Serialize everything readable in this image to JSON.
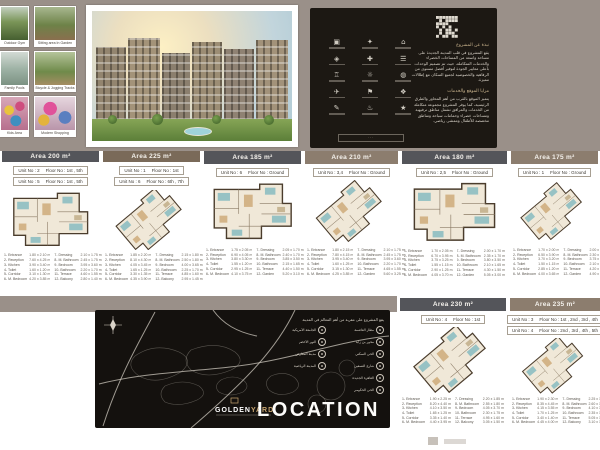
{
  "colors": {
    "page_band": "#9a9089",
    "panel_dark": "#1c1813",
    "header_dark": "#54555a",
    "header_brown": "#7a6a59",
    "header_taupe": "#8c7d6e",
    "accent_gold": "#c9a671"
  },
  "top": {
    "photos": [
      {
        "caption": "Outdoor Gym",
        "variant": "gym"
      },
      {
        "caption": "Sitting area In Garden",
        "variant": "garden"
      },
      {
        "caption": "Family Pools",
        "variant": "pool"
      },
      {
        "caption": "Bicycle & Jogging Tracks",
        "variant": "track"
      },
      {
        "caption": "Kids Area",
        "variant": "kids"
      },
      {
        "caption": "Modern Shopping",
        "variant": "shop"
      }
    ],
    "info_panel": {
      "icons": [
        "▣",
        "✦",
        "⌂",
        "◈",
        "✚",
        "☰",
        "♖",
        "☼",
        "◍",
        "✈",
        "⚑",
        "❖",
        "✎",
        "♨",
        "★"
      ],
      "banner_label": "···",
      "heading_1": "نبذة عن المشروع",
      "paragraph_1": "يقع المشروع في قلب المدينة الجديدة على مساحة واسعة من المساحات الخضراء والخدمات المتكاملة، حيث تم تصميم الوحدات بأعلى معايير الجودة لتوفير أفضل مستوى من الرفاهية والخصوصية لجميع السكان مع إطلالات مميزة.",
      "heading_2": "مزايا الموقع والخدمات",
      "paragraph_2": "يتميز الموقع بالقرب من أهم المحاور والطرق الرئيسية، كما يوفر المشروع مجموعة متكاملة من الخدمات والمرافق تشمل مناطق ترفيهية ومساحات خضراء وحمامات سباحة ومناطق مخصصة للأطفال وممشى رياضي."
    }
  },
  "plans": [
    {
      "area_label": "Area 200 m²",
      "header": "dark",
      "variant": "rect",
      "units": [
        [
          "Unit No : 2",
          "Floor No : 1st , 5th"
        ],
        [
          "Unit No : 5",
          "Floor No : 1st , 5th"
        ]
      ],
      "rooms": [
        "1- Entrance|1.80 x 2.10 m",
        "2- Reception|7.60 x 4.25 m",
        "3- Kitchen|3.90 x 3.40 m",
        "4- Toilet|1.60 x 1.20 m",
        "5- Corridor|3.10 x 1.30 m",
        "6- M. Bedroom|4.20 x 3.85 m",
        "7- Dressing|2.10 x 1.75 m",
        "8- M. Bathroom|2.45 x 1.75 m",
        "9- Bedroom|3.95 x 3.60 m",
        "10- Bathroom|2.20 x 1.70 m",
        "11- Terrace|4.60 x 1.55 m",
        "12- Balcony|2.80 x 1.40 m"
      ]
    },
    {
      "area_label": "Area 225 m²",
      "header": "brown",
      "variant": "diag",
      "units": [
        [
          "Unit No : 1",
          "Floor No : 1st"
        ],
        [
          "Unit No : 6",
          "Floor No : 6th , 7th"
        ]
      ],
      "rooms": [
        "1- Entrance|1.85 x 2.20 m",
        "2- Reception|8.10 x 4.30 m",
        "3- Kitchen|4.05 x 3.45 m",
        "4- Toilet|1.65 x 1.25 m",
        "5- Corridor|3.30 x 1.35 m",
        "6- M. Bedroom|4.35 x 3.90 m",
        "7- Dressing|2.15 x 1.80 m",
        "8- M. Bathroom|2.50 x 1.80 m",
        "9- Bedroom|4.00 x 3.65 m",
        "10- Bathroom|2.25 x 1.70 m",
        "11- Terrace|4.85 x 1.60 m",
        "12- Balcony|2.95 x 1.45 m"
      ]
    },
    {
      "area_label": "Area 185 m²",
      "header": "dark",
      "variant": "rect",
      "units": [
        [
          "Unit No : 6",
          "Floor No : Ground"
        ]
      ],
      "rooms": [
        "1- Entrance|1.75 x 2.05 m",
        "2- Reception|6.90 x 4.05 m",
        "3- Kitchen|3.80 x 3.30 m",
        "4- Toilet|1.55 x 1.20 m",
        "5- Corridor|2.95 x 1.25 m",
        "6- M. Bedroom|4.10 x 3.75 m",
        "7- Dressing|2.05 x 1.70 m",
        "8- M. Bathroom|2.40 x 1.70 m",
        "9- Bedroom|3.85 x 3.50 m",
        "10- Bathroom|2.15 x 1.65 m",
        "11- Terrace|4.40 x 1.50 m",
        "12- Garden|5.20 x 3.10 m"
      ]
    },
    {
      "area_label": "Area 210 m²",
      "header": "taupe",
      "variant": "diag",
      "units": [
        [
          "Unit No : 3,4",
          "Floor No : Ground"
        ]
      ],
      "rooms": [
        "1- Entrance|1.80 x 2.15 m",
        "2- Reception|7.80 x 4.15 m",
        "3- Kitchen|3.95 x 3.40 m",
        "4- Toilet|1.60 x 1.25 m",
        "5- Corridor|3.15 x 1.30 m",
        "6- M. Bedroom|4.25 x 3.85 m",
        "7- Dressing|2.10 x 1.75 m",
        "8- M. Bathroom|2.45 x 1.75 m",
        "9- Bedroom|3.95 x 3.60 m",
        "10- Bathroom|2.20 x 1.70 m",
        "11- Terrace|4.65 x 1.55 m",
        "12- Garden|5.60 x 3.25 m"
      ]
    },
    {
      "area_label": "Area 180 m²",
      "header": "dark",
      "variant": "rect",
      "units": [
        [
          "Unit No : 2,5",
          "Floor No : Ground"
        ]
      ],
      "rooms": [
        "1- Entrance|1.70 x 2.05 m",
        "2- Reception|6.70 x 3.95 m",
        "3- Kitchen|3.75 x 3.25 m",
        "4- Toilet|1.55 x 1.15 m",
        "5- Corridor|2.90 x 1.25 m",
        "6- M. Bedroom|4.05 x 3.70 m",
        "7- Dressing|2.00 x 1.70 m",
        "8- M. Bathroom|2.35 x 1.70 m",
        "9- Bedroom|3.80 x 3.50 m",
        "10- Bathroom|2.10 x 1.65 m",
        "11- Terrace|4.30 x 1.50 m",
        "12- Garden|5.05 x 3.00 m"
      ]
    },
    {
      "area_label": "Area 175 m²",
      "header": "taupe",
      "variant": "diag",
      "units": [
        [
          "Unit No : 1",
          "Floor No : Ground"
        ]
      ],
      "rooms": [
        "1- Entrance|1.70 x 2.00 m",
        "2- Reception|6.50 x 3.90 m",
        "3- Kitchen|3.70 x 3.20 m",
        "4- Toilet|1.50 x 1.15 m",
        "5- Corridor|2.85 x 1.20 m",
        "6- M. Bedroom|4.00 x 3.65 m",
        "7- Dressing|2.00 x 1.65 m",
        "8- M. Bathroom|2.30 x 1.65 m",
        "9- Bedroom|3.75 x 3.45 m",
        "10- Bathroom|2.10 x 1.60 m",
        "11- Terrace|4.20 x 1.45 m",
        "12- Garden|4.90 x 2.95 m"
      ]
    },
    {
      "area_label": "Area 230 m²",
      "header": "dark",
      "variant": "diag",
      "units": [
        [
          "Unit No : 4",
          "Floor No : 1st"
        ]
      ],
      "rooms": [
        "1- Entrance|1.90 x 2.25 m",
        "2- Reception|8.20 x 4.40 m",
        "3- Kitchen|4.10 x 3.50 m",
        "4- Toilet|1.65 x 1.25 m",
        "5- Corridor|3.35 x 1.40 m",
        "6- M. Bedroom|4.40 x 3.95 m",
        "7- Dressing|2.20 x 1.85 m",
        "8- M. Bathroom|2.55 x 1.80 m",
        "9- Bedroom|4.05 x 3.70 m",
        "10- Bathroom|2.30 x 1.75 m",
        "11- Terrace|4.95 x 1.60 m",
        "12- Balcony|3.05 x 1.50 m"
      ]
    },
    {
      "area_label": "Area 235 m²",
      "header": "taupe",
      "variant": "diag",
      "units": [
        [
          "Unit No : 3",
          "Floor No : 1st , 2nd , 3rd , 4th"
        ],
        [
          "Unit No : 4",
          "Floor No : 2nd , 3rd , 4th , 5th"
        ]
      ],
      "rooms": [
        "1- Entrance|1.90 x 2.30 m",
        "2- Reception|8.35 x 4.45 m",
        "3- Kitchen|4.15 x 3.55 m",
        "4- Toilet|1.70 x 1.25 m",
        "5- Corridor|3.40 x 1.40 m",
        "6- M. Bedroom|4.45 x 4.00 m",
        "7- Dressing|2.25 x 1.85 m",
        "8- M. Bathroom|2.60 x 1.85 m",
        "9- Bedroom|4.10 x 3.75 m",
        "10- Bathroom|2.35 x 1.75 m",
        "11- Terrace|5.05 x 1.65 m",
        "12- Balcony|3.10 x 1.50 m"
      ]
    }
  ],
  "location": {
    "title": "LOCATION",
    "project_label_1": "GOLDEN",
    "project_label_2": "YARD",
    "legend_heading": "يقع المشروع على مقربة من أهم المعالم في المدينة",
    "legend_cols": [
      {
        "items": [
          "مطار العاصمة",
          "محور بن زايد",
          "الحي السكني",
          "شارع التسعين",
          "القاهرة الجديدة",
          "الحي الحكومي"
        ]
      },
      {
        "items": [
          "الجامعة الأمريكية",
          "النهر الأخضر",
          "مدينة المعارض",
          "المدينة الرياضية"
        ]
      }
    ]
  }
}
